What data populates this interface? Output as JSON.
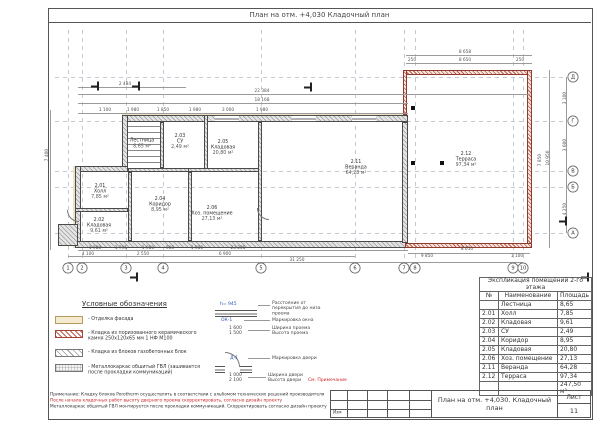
{
  "sheet": {
    "top_title": "План на отм. +4,030   Кладочный план",
    "title_block": {
      "doc_title": "План на отм. +4,030. Кладочный план",
      "sheet_label": "Лист",
      "sheet_number": "11",
      "izm_label": "Изм"
    }
  },
  "legend": {
    "title": "Условные обозначения",
    "items": [
      {
        "cls": "sw-facade",
        "label": "- Отделка фасада",
        "x": 55,
        "y": 316
      },
      {
        "cls": "sw-ceramic",
        "label": "- Кладка из поризованного керамического камня 250х120х65 мм 1 НФ М100",
        "x": 55,
        "y": 330
      },
      {
        "cls": "sw-aerated",
        "label": "- Кладка из блоков газобетонных блок",
        "x": 55,
        "y": 349
      },
      {
        "cls": "sw-gvl",
        "label": "- Металлокаркас обшитый ГВЛ (зашивается после прокладки коммуникаций)",
        "x": 55,
        "y": 364
      }
    ]
  },
  "markings": {
    "window": {
      "height_mark": "h= 945",
      "mark": "ОК-1",
      "width": "1 600",
      "height": "1 500",
      "label_offset": "Расстояние от перекрытия до низа проема",
      "label_mark": "Маркировка окна",
      "label_width": "Ширина проема",
      "label_height": "Высота проема"
    },
    "door": {
      "mark": "Д-1",
      "width": "1 000",
      "height": "2 100",
      "label_mark": "Маркировка двери",
      "label_width": "Ширина двери",
      "label_height": "Высота двери",
      "see_note": "См. Примечание"
    }
  },
  "explication": {
    "title": "Экспликация помещений 2-го этажа",
    "columns": [
      "№",
      "Наименование",
      "Площадь"
    ],
    "rows": [
      [
        "",
        "Лестница",
        "8,65"
      ],
      [
        "2.01",
        "Холл",
        "7,85"
      ],
      [
        "2.02",
        "Кладовая",
        "9,61"
      ],
      [
        "2.03",
        "СУ",
        "2,49"
      ],
      [
        "2.04",
        "Коридор",
        "8,95"
      ],
      [
        "2.05",
        "Кладовая",
        "20,80"
      ],
      [
        "2.06",
        "Хоз. помещение",
        "27,13"
      ],
      [
        "2.11",
        "Веранда",
        "64,28"
      ],
      [
        "2.12",
        "Терраса",
        "97,34"
      ]
    ],
    "total": "247,50 м²"
  },
  "notes": {
    "line1": "Примечание:  Кладку блоков Porotherm осуществлять в соответствии с альбомом технических решений производителя",
    "line2": "После начала кладочных работ высоту дверного проема скорректировать, согласно дизайн проекту",
    "line3": "Металлокаркас обшитый ГВЛ монтируется после прокладки коммуникаций. Скорректировать согласно дизайн проекту"
  },
  "axes_bottom": [
    {
      "label": "1",
      "x": 68,
      "y": 268
    },
    {
      "label": "2",
      "x": 82,
      "y": 268
    },
    {
      "label": "3",
      "x": 126,
      "y": 268
    },
    {
      "label": "4",
      "x": 163,
      "y": 268
    },
    {
      "label": "5",
      "x": 261,
      "y": 268
    },
    {
      "label": "6",
      "x": 355,
      "y": 268
    },
    {
      "label": "7",
      "x": 404,
      "y": 268
    },
    {
      "label": "8",
      "x": 415,
      "y": 268
    },
    {
      "label": "9",
      "x": 513,
      "y": 268
    },
    {
      "label": "10",
      "x": 523,
      "y": 268
    }
  ],
  "axes_right": [
    {
      "label": "Д",
      "x": 573,
      "y": 77
    },
    {
      "label": "Г",
      "x": 573,
      "y": 121
    },
    {
      "label": "В",
      "x": 573,
      "y": 171
    },
    {
      "label": "Б",
      "x": 573,
      "y": 187
    },
    {
      "label": "А",
      "x": 573,
      "y": 233
    }
  ],
  "dims": [
    {
      "v": "2 484",
      "x": 125,
      "y": 84
    },
    {
      "v": "22 384",
      "x": 262,
      "y": 91
    },
    {
      "v": "18 168",
      "x": 262,
      "y": 100
    },
    {
      "v": "1 100",
      "x": 105,
      "y": 110
    },
    {
      "v": "1 980",
      "x": 133,
      "y": 110
    },
    {
      "v": "1 850",
      "x": 163,
      "y": 110
    },
    {
      "v": "1 980",
      "x": 195,
      "y": 110
    },
    {
      "v": "3 000",
      "x": 228,
      "y": 110
    },
    {
      "v": "1 980",
      "x": 262,
      "y": 110
    },
    {
      "v": "8 658",
      "x": 465,
      "y": 52
    },
    {
      "v": "250",
      "x": 412,
      "y": 60
    },
    {
      "v": "8 650",
      "x": 465,
      "y": 60
    },
    {
      "v": "250",
      "x": 520,
      "y": 60
    },
    {
      "v": "3 100",
      "x": 565,
      "y": 98,
      "rot": -90
    },
    {
      "v": "3 600",
      "x": 565,
      "y": 145,
      "rot": -90
    },
    {
      "v": "4 250",
      "x": 565,
      "y": 209,
      "rot": -90
    },
    {
      "v": "10 950",
      "x": 548,
      "y": 158,
      "rot": -90
    },
    {
      "v": "7 850",
      "x": 540,
      "y": 160,
      "rot": -90
    },
    {
      "v": "7 400",
      "x": 47,
      "y": 155,
      "rot": -90
    },
    {
      "v": "1 980",
      "x": 95,
      "y": 248
    },
    {
      "v": "1 795",
      "x": 121,
      "y": 248
    },
    {
      "v": "1 980",
      "x": 148,
      "y": 248
    },
    {
      "v": "900",
      "x": 170,
      "y": 248
    },
    {
      "v": "1 980",
      "x": 197,
      "y": 248
    },
    {
      "v": "23 205",
      "x": 238,
      "y": 248
    },
    {
      "v": "4 100",
      "x": 88,
      "y": 254
    },
    {
      "v": "2 550",
      "x": 143,
      "y": 254
    },
    {
      "v": "6 900",
      "x": 225,
      "y": 254
    },
    {
      "v": "31 250",
      "x": 297,
      "y": 260
    },
    {
      "v": "8 650",
      "x": 467,
      "y": 249
    },
    {
      "v": "9 850",
      "x": 427,
      "y": 256
    },
    {
      "v": "1 100",
      "x": 517,
      "y": 256
    }
  ],
  "rooms": [
    {
      "id": "",
      "name": "Лестница",
      "area": "8,65 м²",
      "x": 142,
      "y": 144
    },
    {
      "id": "2.01",
      "name": "Холл",
      "area": "7,85 м²",
      "x": 100,
      "y": 192
    },
    {
      "id": "2.02",
      "name": "Кладовая",
      "area": "9,61 м²",
      "x": 99,
      "y": 226
    },
    {
      "id": "2.03",
      "name": "СУ",
      "area": "2,49 м²",
      "x": 180,
      "y": 142
    },
    {
      "id": "2.04",
      "name": "Коридор",
      "area": "8,95 м²",
      "x": 160,
      "y": 205
    },
    {
      "id": "2.05",
      "name": "Кладовая",
      "area": "20,80 м²",
      "x": 223,
      "y": 148
    },
    {
      "id": "2.06",
      "name": "Хоз. помещение",
      "area": "27,13 м²",
      "x": 212,
      "y": 214
    },
    {
      "id": "2.11",
      "name": "Веранда",
      "area": "64,28 м²",
      "x": 356,
      "y": 168
    },
    {
      "id": "2.12",
      "name": "Терраса",
      "area": "97,34 м²",
      "x": 466,
      "y": 160
    }
  ],
  "section_marks": [
    {
      "label": "1",
      "x": 95,
      "y": 86
    },
    {
      "label": "1",
      "x": 136,
      "y": 86
    },
    {
      "label": "1",
      "x": 308,
      "y": 87
    },
    {
      "label": "1",
      "x": 134,
      "y": 277
    },
    {
      "label": "1",
      "x": 585,
      "y": 277
    },
    {
      "label": "1",
      "x": 563,
      "y": 221
    }
  ]
}
